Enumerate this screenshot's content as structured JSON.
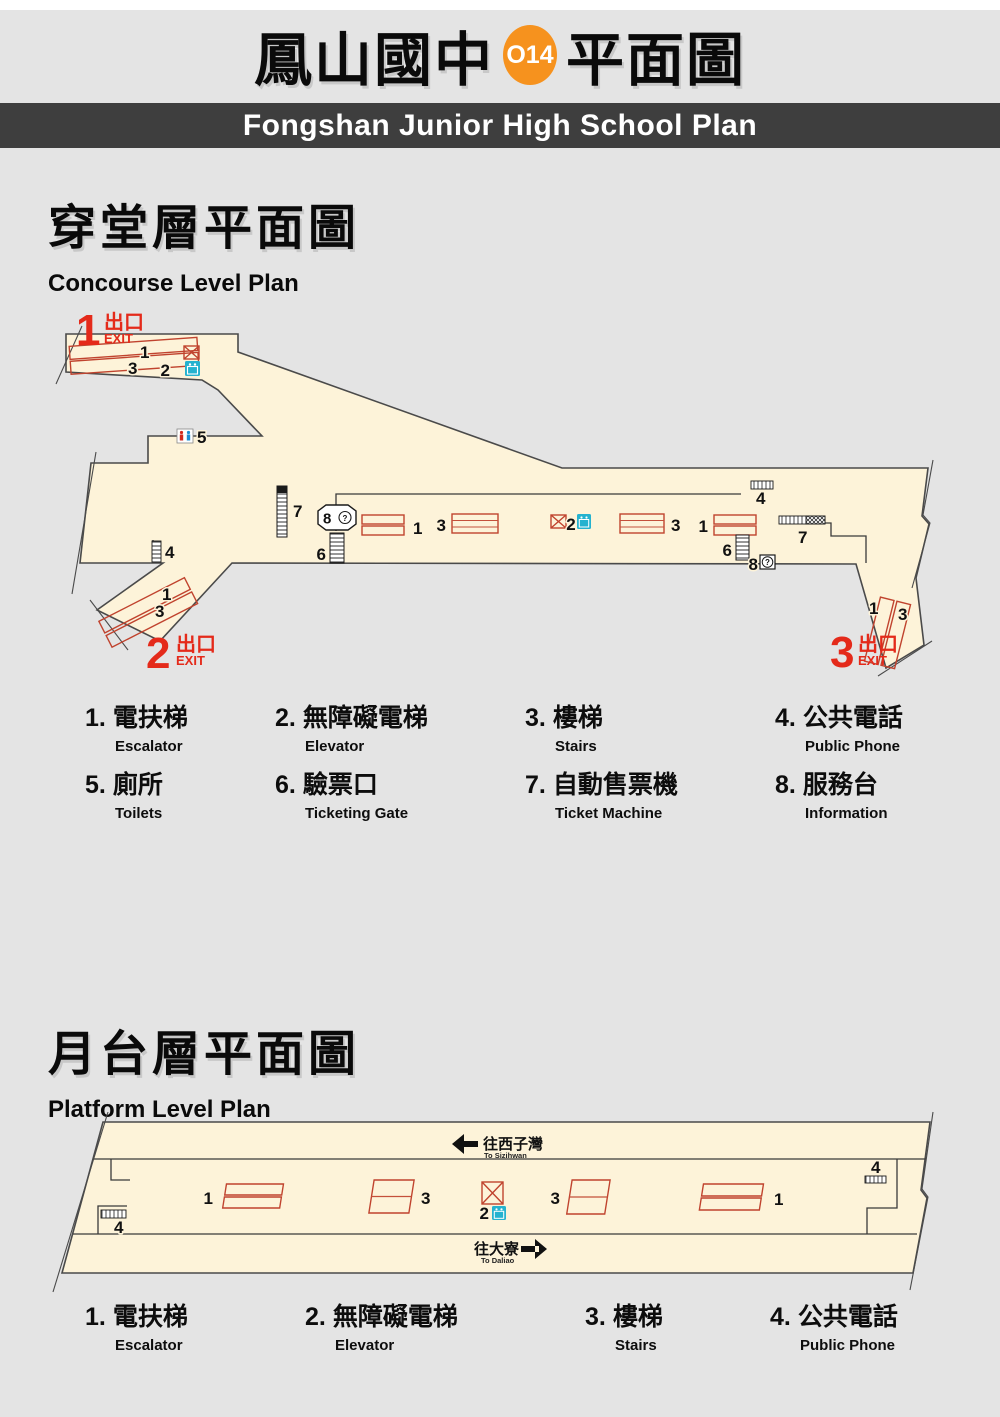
{
  "header": {
    "title_left": "鳳山國中",
    "station_code": "O14",
    "title_right": "平面圖",
    "banner": "Fongshan Junior High School Plan"
  },
  "colors": {
    "orange": "#f6921e",
    "exit_red": "#e42a1a",
    "icon_red": "#c0432e",
    "cyan": "#25b2cf",
    "floor": "#fdf3d9"
  },
  "concourse": {
    "title": "穿堂層平面圖",
    "subtitle": "Concourse Level Plan",
    "exits": {
      "e1": {
        "num": "1",
        "cjk": "出口",
        "en": "EXIT"
      },
      "e2": {
        "num": "2",
        "cjk": "出口",
        "en": "EXIT"
      },
      "e3": {
        "num": "3",
        "cjk": "出口",
        "en": "EXIT"
      }
    },
    "legend": [
      {
        "num": "1.",
        "cjk": "電扶梯",
        "en": "Escalator"
      },
      {
        "num": "2.",
        "cjk": "無障礙電梯",
        "en": "Elevator"
      },
      {
        "num": "3.",
        "cjk": "樓梯",
        "en": "Stairs"
      },
      {
        "num": "4.",
        "cjk": "公共電話",
        "en": "Public Phone"
      },
      {
        "num": "5.",
        "cjk": "廁所",
        "en": "Toilets"
      },
      {
        "num": "6.",
        "cjk": "驗票口",
        "en": "Ticketing Gate"
      },
      {
        "num": "7.",
        "cjk": "自動售票機",
        "en": "Ticket Machine"
      },
      {
        "num": "8.",
        "cjk": "服務台",
        "en": "Information"
      }
    ]
  },
  "platform": {
    "title": "月台層平面圖",
    "subtitle": "Platform Level Plan",
    "directions": {
      "left": {
        "cjk": "往西子灣",
        "en": "To Sizihwan"
      },
      "right": {
        "cjk": "往大寮",
        "en": "To Daliao"
      }
    },
    "legend": [
      {
        "num": "1.",
        "cjk": "電扶梯",
        "en": "Escalator"
      },
      {
        "num": "2.",
        "cjk": "無障礙電梯",
        "en": "Elevator"
      },
      {
        "num": "3.",
        "cjk": "樓梯",
        "en": "Stairs"
      },
      {
        "num": "4.",
        "cjk": "公共電話",
        "en": "Public Phone"
      }
    ]
  },
  "nums": {
    "n1": "1",
    "n2": "2",
    "n3": "3",
    "n4": "4",
    "n5": "5",
    "n6": "6",
    "n7": "7",
    "n8": "8",
    "q": "?"
  }
}
